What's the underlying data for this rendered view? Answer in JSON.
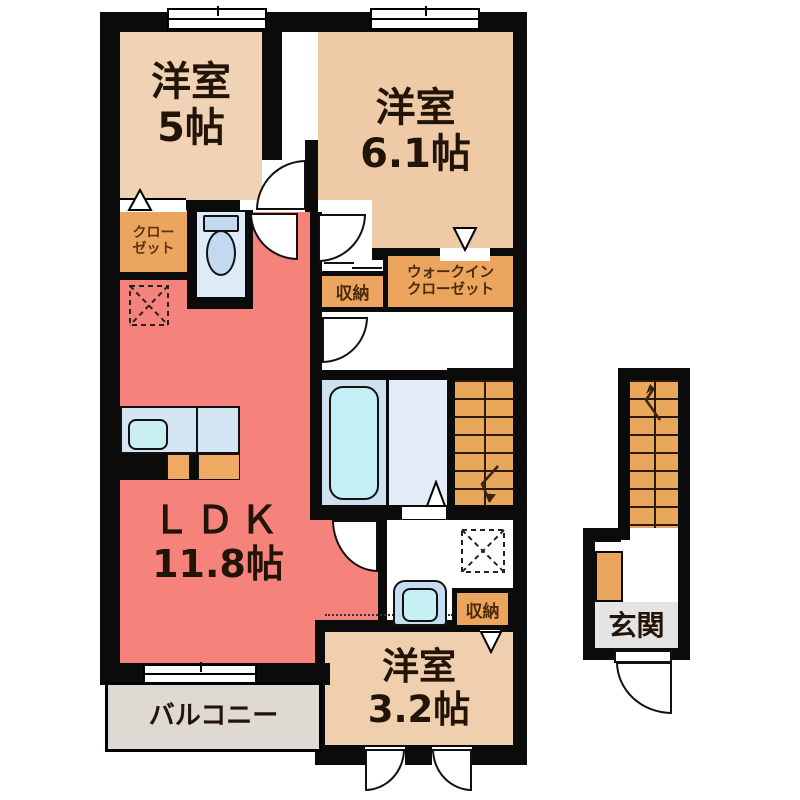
{
  "floor_plan": {
    "rooms": {
      "bedroom5": {
        "name": "洋室",
        "size": "5帖"
      },
      "bedroom61": {
        "name": "洋室",
        "size": "6.1帖"
      },
      "bedroom32": {
        "name": "洋室",
        "size": "3.2帖"
      },
      "ldk": {
        "name": "ＬＤＫ",
        "size": "11.8帖"
      },
      "closet": {
        "line1": "クロー",
        "line2": "ゼット"
      },
      "walk_in_closet": {
        "line1": "ウォークイン",
        "line2": "クローゼット"
      },
      "storage_upper": {
        "name": "収納"
      },
      "storage_lower": {
        "name": "収納"
      },
      "balcony": {
        "name": "バルコニー"
      },
      "entrance": {
        "name": "玄関"
      }
    },
    "colors": {
      "wall": "#0b0b0b",
      "bedroom_fill": "#efcfae",
      "ldk_fill": "#f5837c",
      "closet_fill": "#eca55f",
      "stairs_fill": "#e9a75c",
      "bath_fill": "#cfe0f1",
      "tub_fill": "#c3f0f5",
      "toilet_room_fill": "#dfeaf8",
      "balcony_fill": "#ded9d2",
      "entrance_floor_fill": "#e4e4e4",
      "label_color": "#231408"
    }
  }
}
